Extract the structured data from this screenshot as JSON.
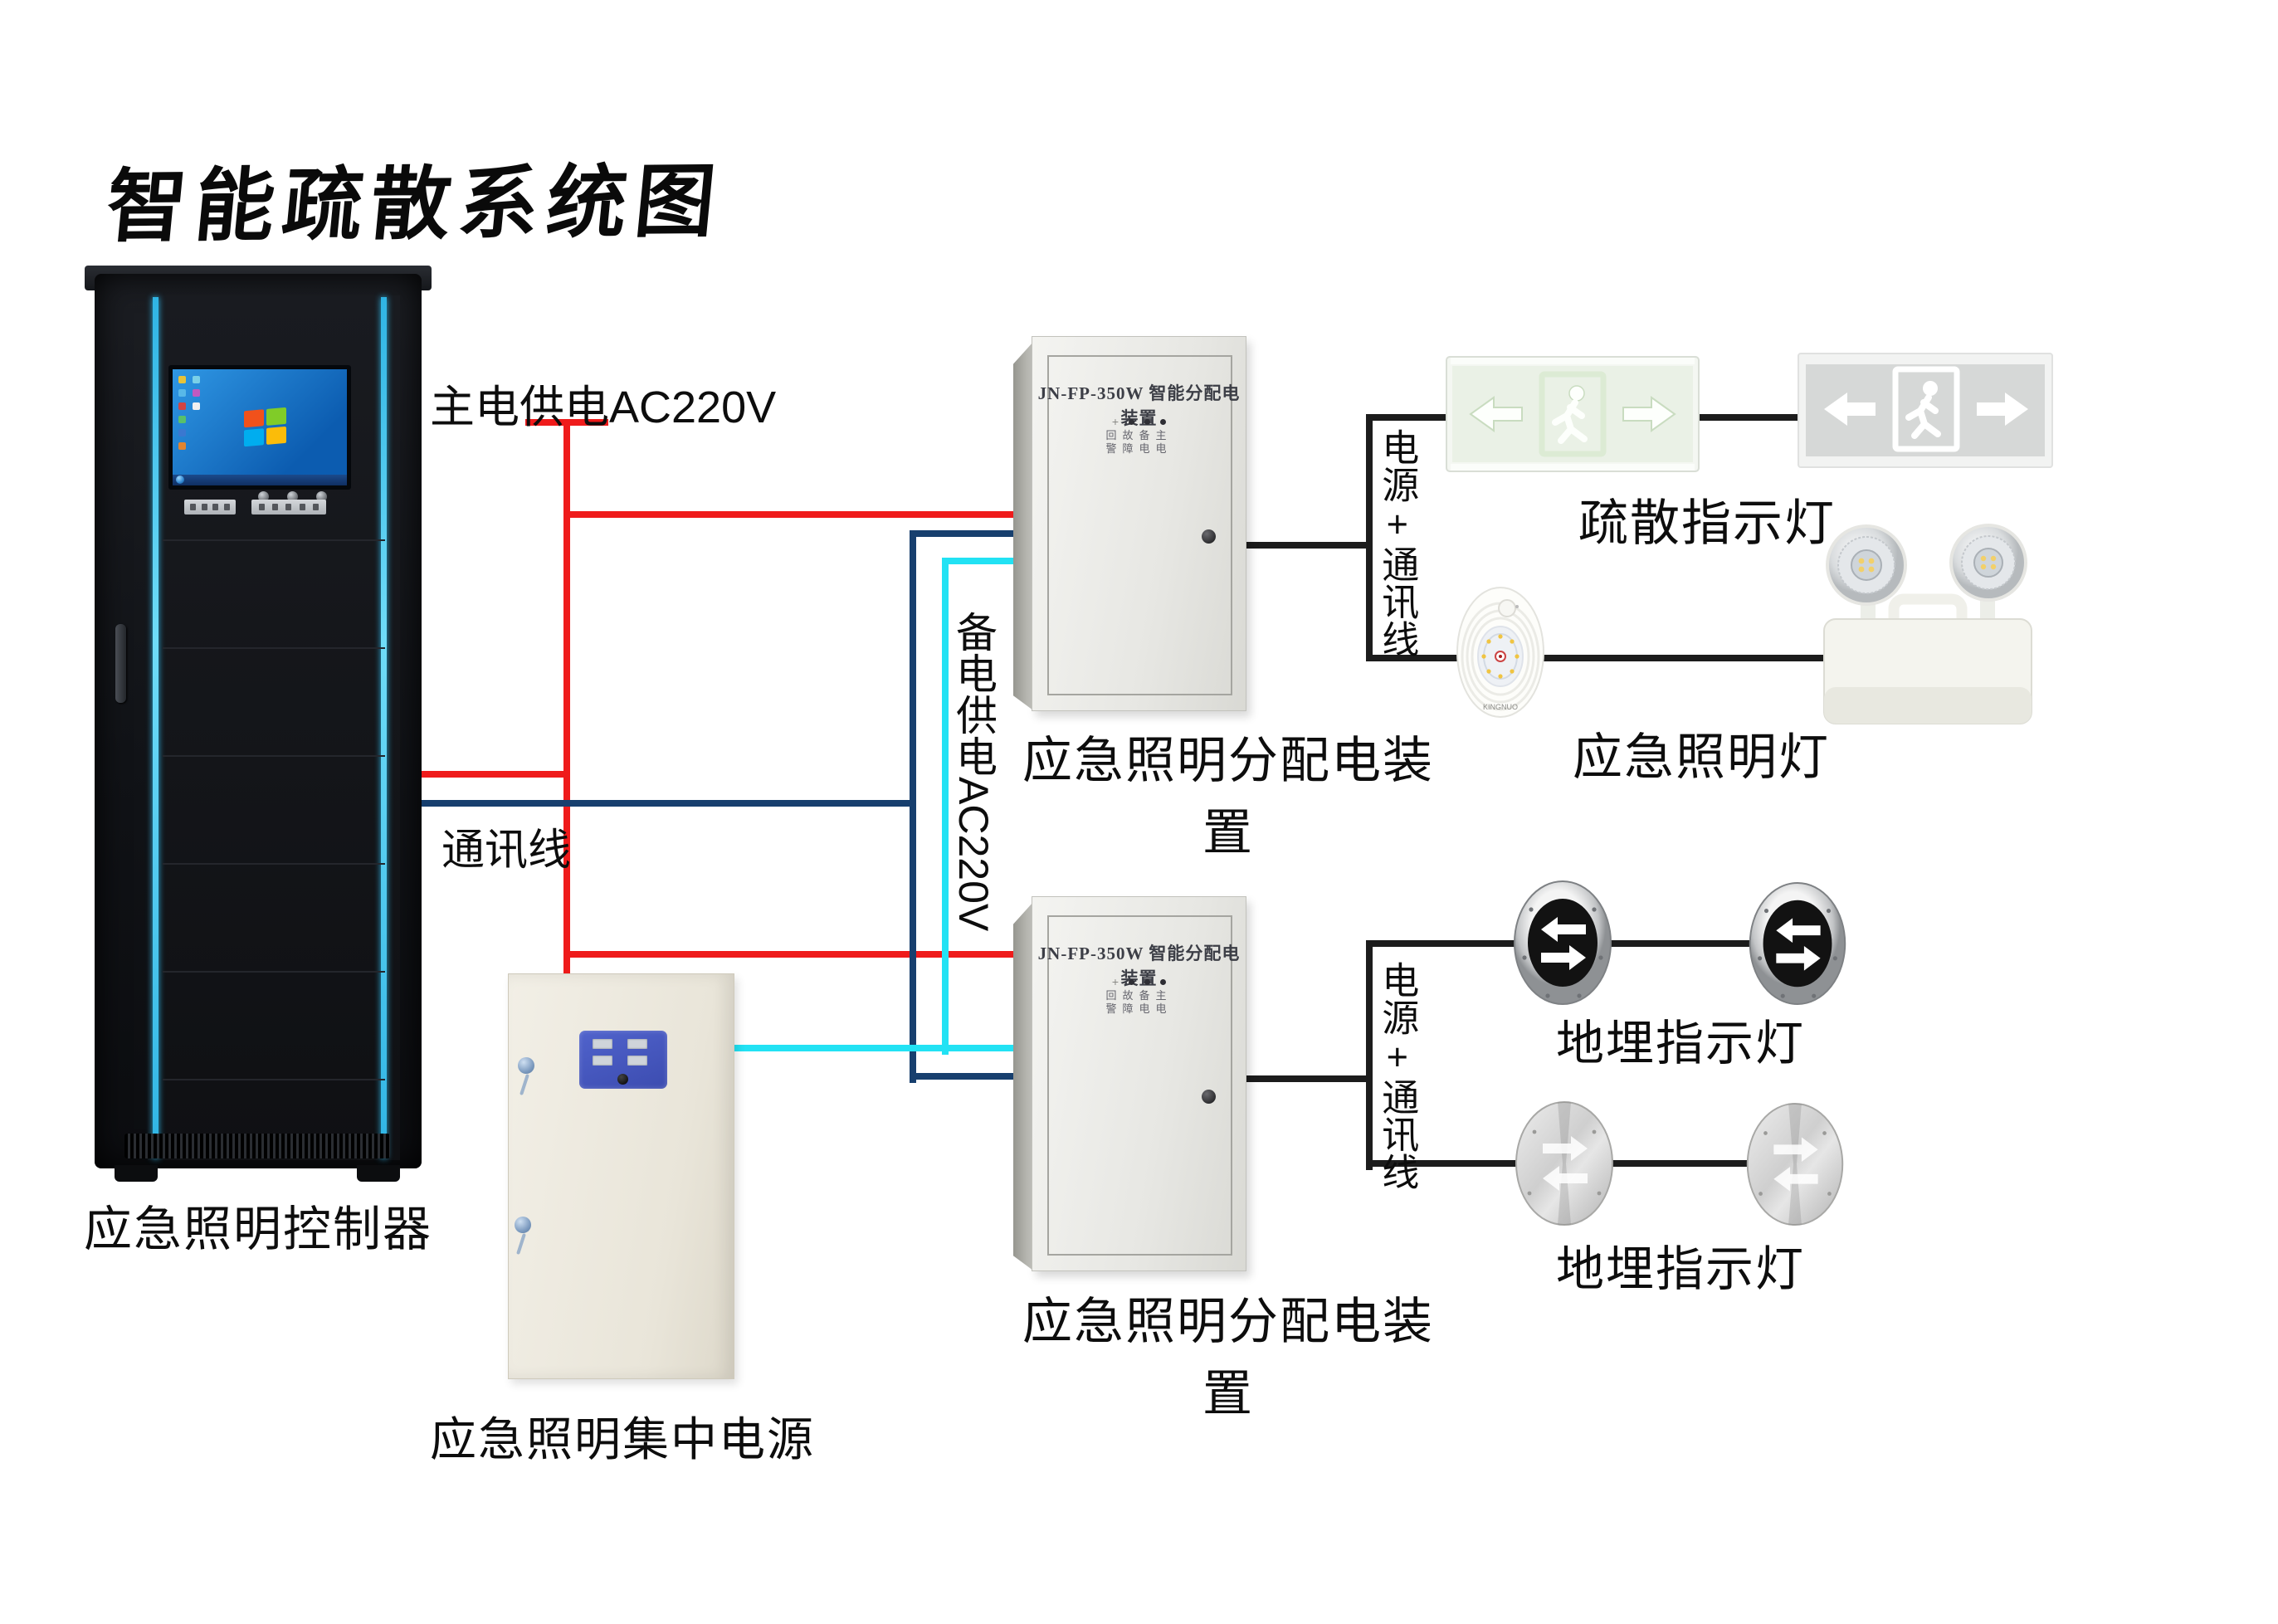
{
  "title": "智能疏散系统图",
  "colors": {
    "main_power": "#ef1b1b",
    "comm_line": "#173f6e",
    "backup_power": "#22e2f4",
    "black_wire": "#1c1c1c",
    "rack_accent": "#2fb4e4",
    "psu_panel_blue": "#4656bc"
  },
  "wire_labels": {
    "main_power": "主电供电AC220V",
    "comm": "通讯线",
    "backup_power": "备电供电AC220V",
    "power_comm_1": "电源+通讯线",
    "power_comm_2": "电源+通讯线"
  },
  "devices": {
    "controller": {
      "label": "应急照明控制器"
    },
    "central_power": {
      "label": "应急照明集中电源"
    },
    "dist_box_1": {
      "panel_title": "JN-FP-350W 智能分配电装置",
      "indicator_row_1": "回故备主",
      "indicator_row_2": "警障电电",
      "label": "应急照明分配电装置"
    },
    "dist_box_2": {
      "panel_title": "JN-FP-350W 智能分配电装置",
      "indicator_row_1": "回故备主",
      "indicator_row_2": "警障电电",
      "label": "应急照明分配电装置"
    },
    "evac_signs": {
      "label": "疏散指示灯"
    },
    "emergency_lights": {
      "label": "应急照明灯",
      "brand": "KINGNUO"
    },
    "ground_lights_1": {
      "label": "地埋指示灯"
    },
    "ground_lights_2": {
      "label": "地埋指示灯"
    }
  }
}
